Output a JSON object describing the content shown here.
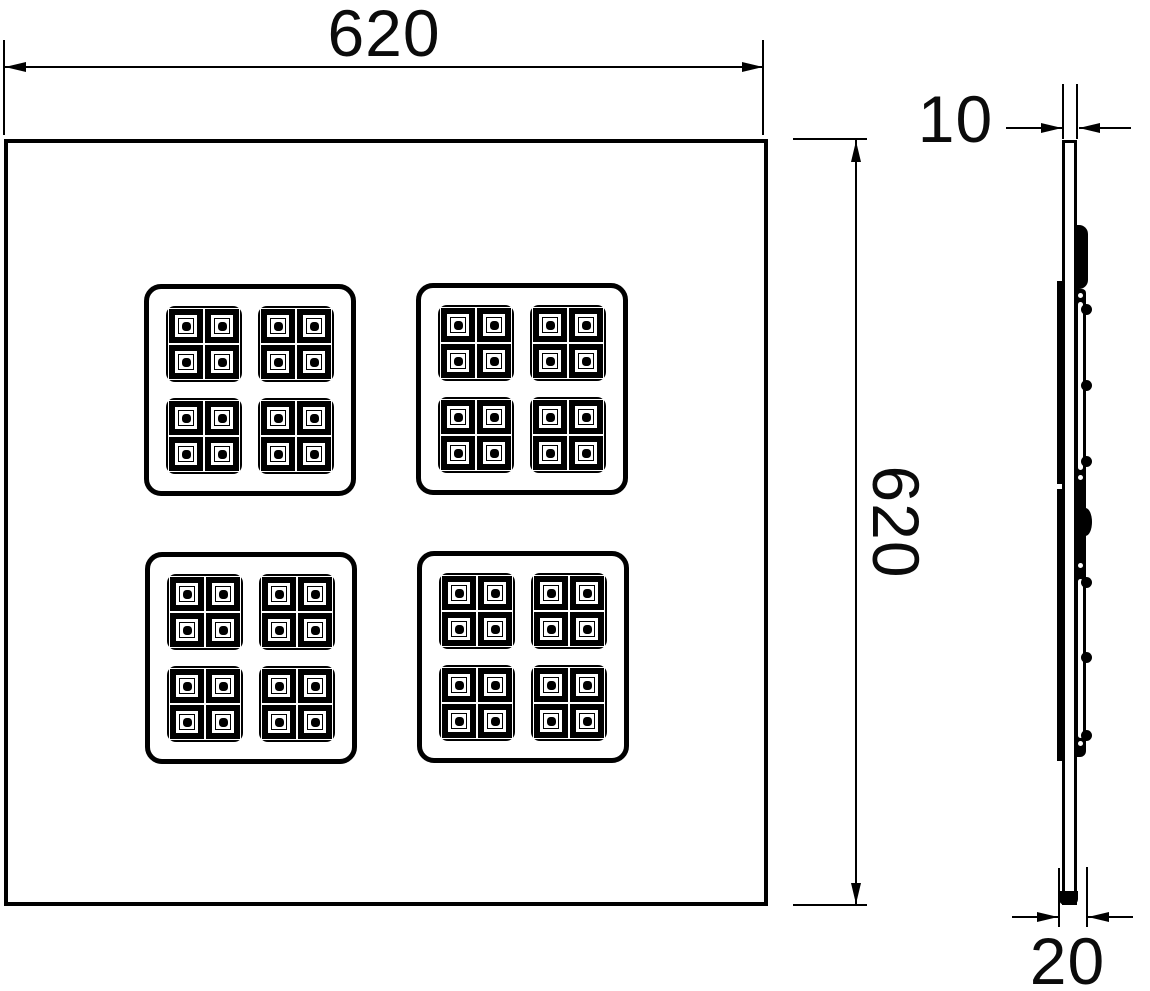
{
  "drawing": {
    "title": "",
    "front_view": {
      "width_dim": {
        "value": "620"
      },
      "height_dim": {
        "value": "620"
      },
      "led_matrix": {
        "cluster_rows": 2,
        "cluster_cols": 2,
        "module_rows": 2,
        "module_cols": 2,
        "cell_rows": 2,
        "cell_cols": 2
      }
    },
    "side_view": {
      "thickness_dim": {
        "value": "10"
      },
      "depth_dim": {
        "value": "20"
      }
    },
    "colors": {
      "line": "#000000",
      "background": "#ffffff"
    }
  }
}
